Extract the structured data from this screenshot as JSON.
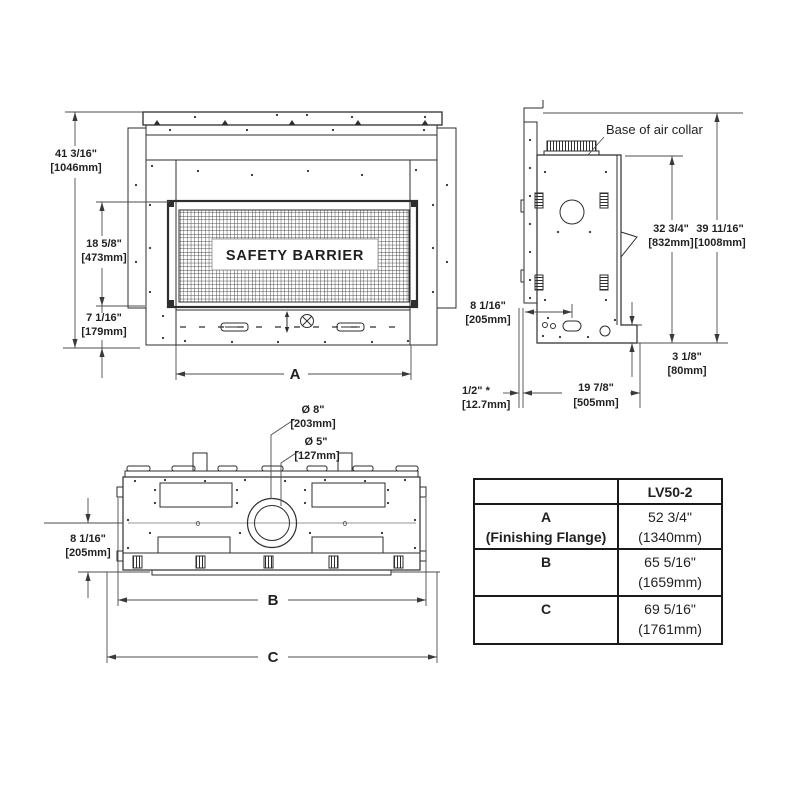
{
  "front_view": {
    "safety_barrier_label": "SAFETY BARRIER",
    "dim_total_height_in": "41 3/16\"",
    "dim_total_height_mm": "[1046mm]",
    "dim_opening_height_in": "18 5/8\"",
    "dim_opening_height_mm": "[473mm]",
    "dim_base_height_in": "7 1/16\"",
    "dim_base_height_mm": "[179mm]",
    "dim_width_label": "A"
  },
  "side_view": {
    "air_collar_label": "Base of air collar",
    "dim_body_height_in": "32 3/4\"",
    "dim_body_height_mm": "[832mm]",
    "dim_overall_height_in": "39 11/16\"",
    "dim_overall_height_mm": "[1008mm]",
    "dim_inlet_offset_in": "8 1/16\"",
    "dim_inlet_offset_mm": "[205mm]",
    "dim_base_step_in": "3 1/8\"",
    "dim_base_step_mm": "[80mm]",
    "dim_flange_in": "1/2\" *",
    "dim_flange_mm": "[12.7mm]",
    "dim_depth_in": "19 7/8\"",
    "dim_depth_mm": "[505mm]"
  },
  "top_view": {
    "dim_flue_outer_in": "Ø 8\"",
    "dim_flue_outer_mm": "[203mm]",
    "dim_flue_inner_in": "Ø 5\"",
    "dim_flue_inner_mm": "[127mm]",
    "dim_center_offset_in": "8 1/16\"",
    "dim_center_offset_mm": "[205mm]",
    "dim_b_label": "B",
    "dim_c_label": "C",
    "zero_mark": "0"
  },
  "spec_table": {
    "model_header": "LV50-2",
    "rows": [
      {
        "label_line1": "A",
        "label_line2": "(Finishing Flange)",
        "value_line1": "52 3/4\"",
        "value_line2": "(1340mm)"
      },
      {
        "label_line1": "B",
        "label_line2": "",
        "value_line1": "65 5/16\"",
        "value_line2": "(1659mm)"
      },
      {
        "label_line1": "C",
        "label_line2": "",
        "value_line1": "69 5/16\"",
        "value_line2": "(1761mm)"
      }
    ]
  }
}
